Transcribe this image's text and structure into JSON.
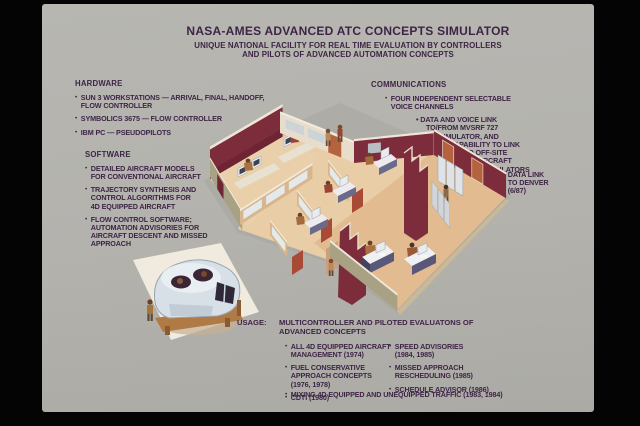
{
  "ui": {
    "bullet_char": "•"
  },
  "title": {
    "line1": "NASA-AMES ADVANCED ATC CONCEPTS SIMULATOR",
    "line2": "UNIQUE NATIONAL FACILITY FOR REAL TIME EVALUATION BY CONTROLLERS\nAND PILOTS OF ADVANCED AUTOMATION CONCEPTS"
  },
  "hardware": {
    "heading": "HARDWARE",
    "items": [
      "SUN 3 WORKSTATIONS — ARRIVAL, FINAL, HANDOFF,\nFLOW CONTROLLER",
      "SYMBOLICS 3675 — FLOW CONTROLLER",
      "IBM PC — PSEUDOPILOTS"
    ]
  },
  "software": {
    "heading": "SOFTWARE",
    "items": [
      "DETAILED AIRCRAFT MODELS\nFOR CONVENTIONAL AIRCRAFT",
      "TRAJECTORY SYNTHESIS AND\nCONTROL ALGORITHMS FOR\n4D EQUIPPED AIRCRAFT",
      "FLOW CONTROL SOFTWARE;\nAUTOMATION ADVISORIES FOR\nAIRCRAFT DESCENT AND MISSED\nAPPROACH"
    ]
  },
  "communications": {
    "heading": "COMMUNICATIONS",
    "items": [
      "FOUR INDEPENDENT SELECTABLE\nVOICE CHANNELS",
      "DATA AND VOICE LINK\nTO/FROM MVSRF 727\nSIMULATOR, AND\nCAPABILITY TO LINK\nTO OFF-SITE\nAIRCRAFT\nSIMULATORS",
      "DATA LINK\nTO DENVER\n(6/87)"
    ]
  },
  "usage": {
    "label": "USAGE:",
    "heading": "MULTICONTROLLER AND PILOTED EVALUATONS OF\nADVANCED CONCEPTS",
    "column1": [
      "ALL 4D EQUIPPED AIRCRAFT\nMANAGEMENT (1974)",
      "FUEL CONSERVATIVE\nAPPROACH CONCEPTS\n(1976, 1978)",
      "CDTI (1980)"
    ],
    "column2": [
      "SPEED ADVISORIES\n(1984, 1985)",
      "MISSED APPROACH\nRESCHEDULING (1985)",
      "SCHEDULE ADVISOR (1986)"
    ],
    "footnote": "MIXING 4D EQUIPPED AND UNEQUIPPED TRAFFIC (1983, 1984)"
  },
  "colors": {
    "frame_black": "#040404",
    "slide_background": "#b3b2ad",
    "text_purple": "#3e2546",
    "wall_maroon": "#7d2c3b",
    "wall_olive": "#a9a184",
    "wall_cream": "#e7ddca",
    "floor_tan": "#e2bb90",
    "door_orange": "#b5623f",
    "glass_pane": "#e4eaec"
  }
}
